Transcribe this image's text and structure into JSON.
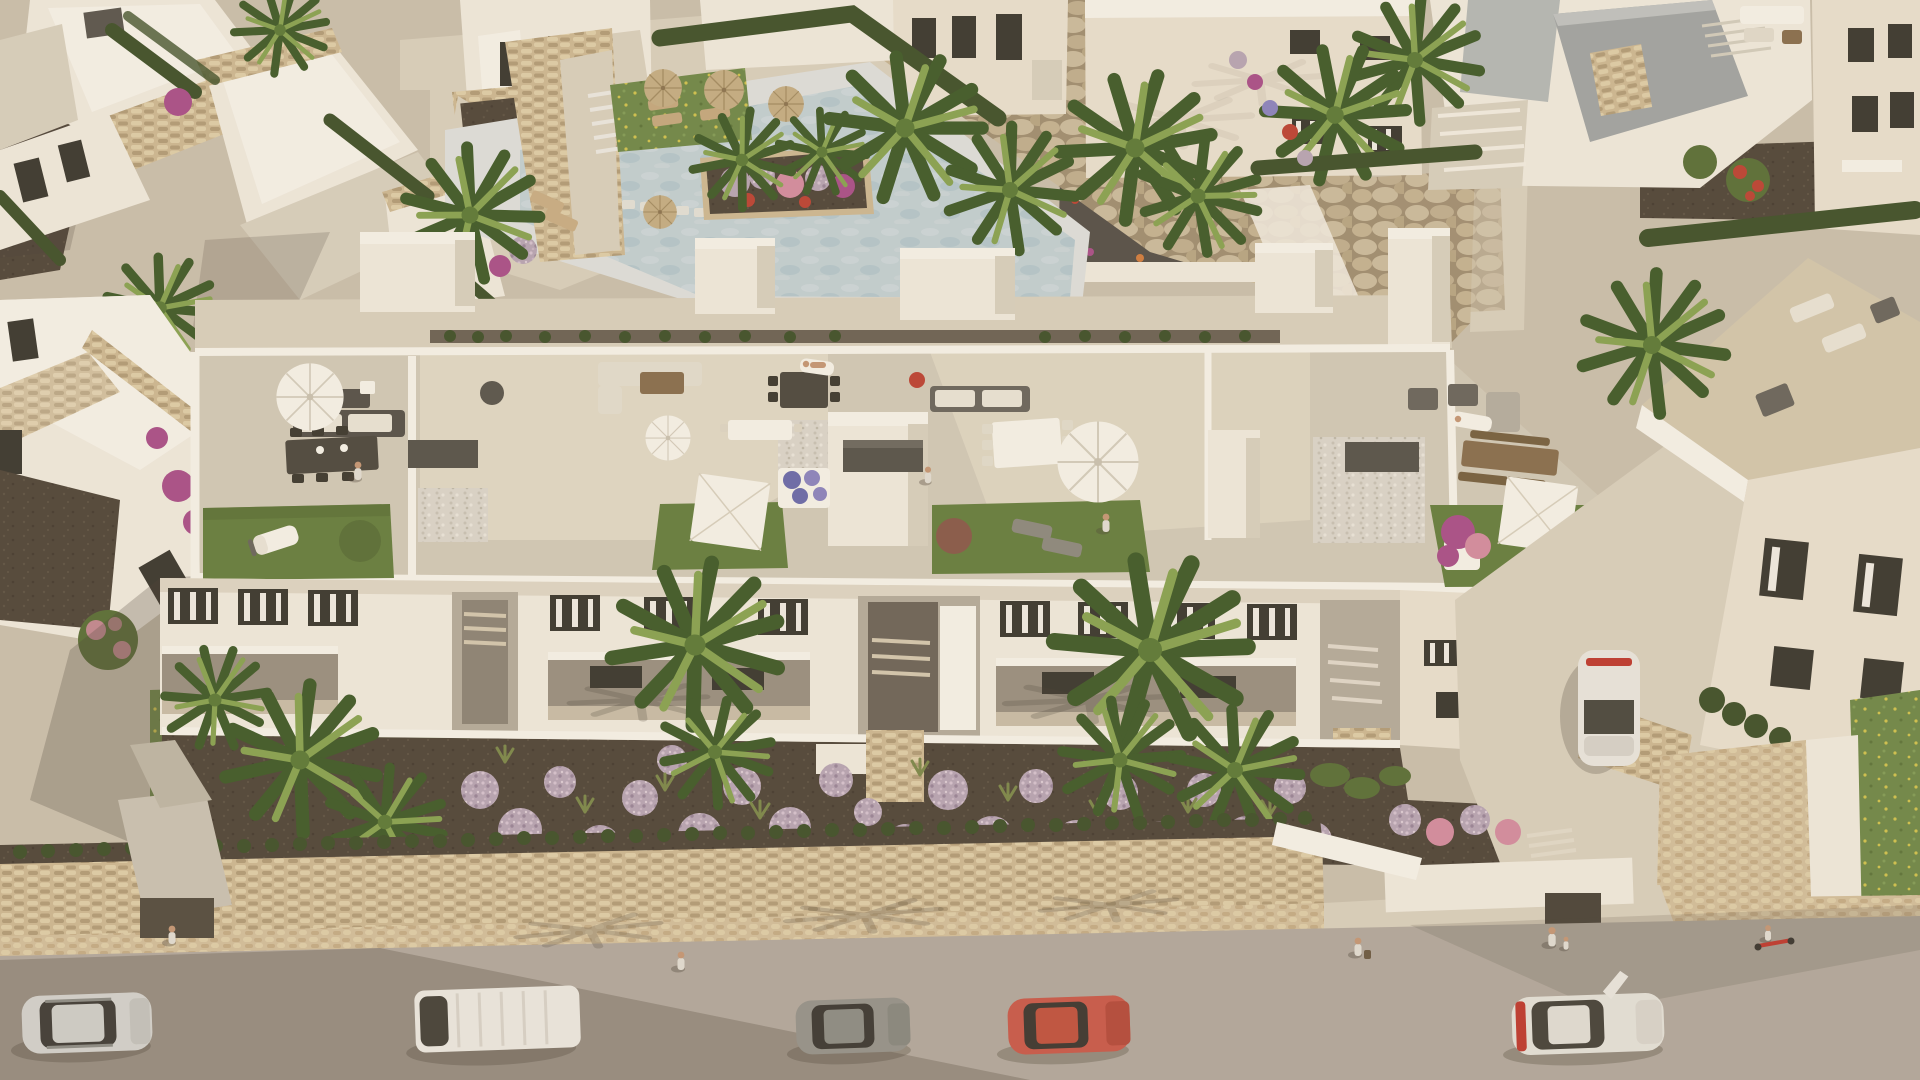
{
  "scene": {
    "title": "Aerial render of a new-build white apartment residence at golden hour",
    "view": "high oblique aerial view looking down on a Mediterranean residential complex",
    "lighting": "low warm evening sun from the upper right casting long soft shadows toward the lower left",
    "foreground": "asphalt street with parked cars, cobbled sidewalk and a stone boundary wall",
    "midground": "long three-storey white apartment block with four furnished rooftop terraces and a lavender front garden",
    "background": "community pool with boulder rockery, white villas, hedges and palm trees"
  },
  "palette": {
    "ground": "#cfc5b2",
    "path": "#ded5c2",
    "road": "#b6ada2",
    "road_lit": "#bfb6aa",
    "sidewalk": "#d8c4a0",
    "cobble_light": "#e4d3ae",
    "cobble_dark": "#c9b189",
    "stone": "#d2bd97",
    "stone_dark": "#b5a07a",
    "soil": "#4f4539",
    "hedge": "#3f5129",
    "hedge_light": "#5a7036",
    "lawn": "#66813f",
    "lawn_dark": "#54692f",
    "meadow": "#708a49",
    "flower_yellow": "#d6c94e",
    "palm": "#5d7c36",
    "palm_dark": "#3f5b28",
    "palm_light": "#8aa652",
    "lavender": "#bca9ba",
    "lavender_dark": "#9b879d",
    "lavender_light": "#dbc8d6",
    "magenta": "#ad4f8c",
    "blossom": "#d98ea4",
    "red_flower": "#c04233",
    "blue_flower": "#6a6bb0",
    "white_wall": "#f6f1e5",
    "white_bright": "#fcfaf1",
    "wall_shade": "#ddd5c4",
    "cream": "#efe7d6",
    "terrace": "#d7cfbd",
    "terrace_lit": "#eae2cf",
    "gravel": "#c6c1b4",
    "pebble": "#e0dcd1",
    "gravel_path": "#565049",
    "dark_box": "#57534b",
    "wood": "#8a6f4e",
    "roof_gray": "#a4a8a7",
    "roof_gray_dark": "#8c9190",
    "pool_deck": "#e3e6e3",
    "pool_water": "#c6d5d9",
    "pool_water_deep": "#afc6cd",
    "boulder": "#d0c1a2",
    "boulder_dark": "#a39174",
    "glass": "#3a372f",
    "frame": "#f6f3ea",
    "shadow": "#4a4236",
    "skin": "#c99a78",
    "denim": "#5577a0",
    "taillight": "#c23a2f"
  },
  "objects": {
    "main_building": {
      "type": "three-storey white apartment block with roof terraces",
      "terraces": [
        {
          "name": "terrace-1",
          "amenities": "round white parasol, dark lounge sofa, dining table for six, lawn with white double sun lounger, shrub, pebble patch, storage bench"
        },
        {
          "name": "terrace-2",
          "amenities": "white lounge sofa, wood coffee table, dark dining table, white square shade sail, planters with blue flowers, lawn strip, sunbather"
        },
        {
          "name": "terrace-3",
          "amenities": "gray lounge sofa, long white dining table with eight chairs, large white parasol, lawn with red shrub, two loungers, resident standing"
        },
        {
          "name": "terrace-4",
          "amenities": "pebble patch with storage bench, metal lounge chairs, wooden dining table with benches, white square shade sail, pink bougainvillea, lawn, parasol"
        }
      ],
      "facade": "white facade, slatted dark windows, recessed stairwells, covered ground-floor loggias"
    },
    "pool_area": {
      "description": "pale mosaic community pool with stepping stones, planter of palms and flowers, straw parasols, timber sun loungers, lawn and white stairs"
    },
    "garden": {
      "description": "front bed of round lavender bushes, ornamental grasses and fan palms behind a stone street wall with hedge"
    },
    "vehicles": [
      {
        "name": "silver-crossover",
        "color": "#d8d8d3",
        "detail": "roof rails, parked on street far left"
      },
      {
        "name": "white-van",
        "color": "#f1efe8",
        "detail": "panel van parked left of center"
      },
      {
        "name": "gray-hatchback",
        "color": "#97968e",
        "detail": "parked center"
      },
      {
        "name": "red-hatchback",
        "color": "#cd5a4b",
        "detail": "parked right of center"
      },
      {
        "name": "white-sedan",
        "color": "#eae8e0",
        "detail": "driver door open, far right"
      },
      {
        "name": "driveway-car",
        "color": "#efede6",
        "detail": "white car parked in side driveway"
      }
    ],
    "people": [
      {
        "name": "pedestrian-at-gate",
        "where": "street gate, left"
      },
      {
        "name": "pedestrian-crossing",
        "where": "road, center left"
      },
      {
        "name": "woman-with-bag",
        "where": "sidewalk, right"
      },
      {
        "name": "adult-with-child",
        "where": "sidewalk, right"
      },
      {
        "name": "kid-on-scooter",
        "where": "sidewalk, far right"
      },
      {
        "name": "resident-terrace-1",
        "where": "rooftop dining table"
      },
      {
        "name": "sunbather-terrace-2",
        "where": "rooftop lounger"
      },
      {
        "name": "resident-terrace-3",
        "where": "rooftop lawn"
      }
    ],
    "neighbourhood": "white villas with gray flat roofs, stone-clad accents, cypress hedges and palms surround the block"
  }
}
